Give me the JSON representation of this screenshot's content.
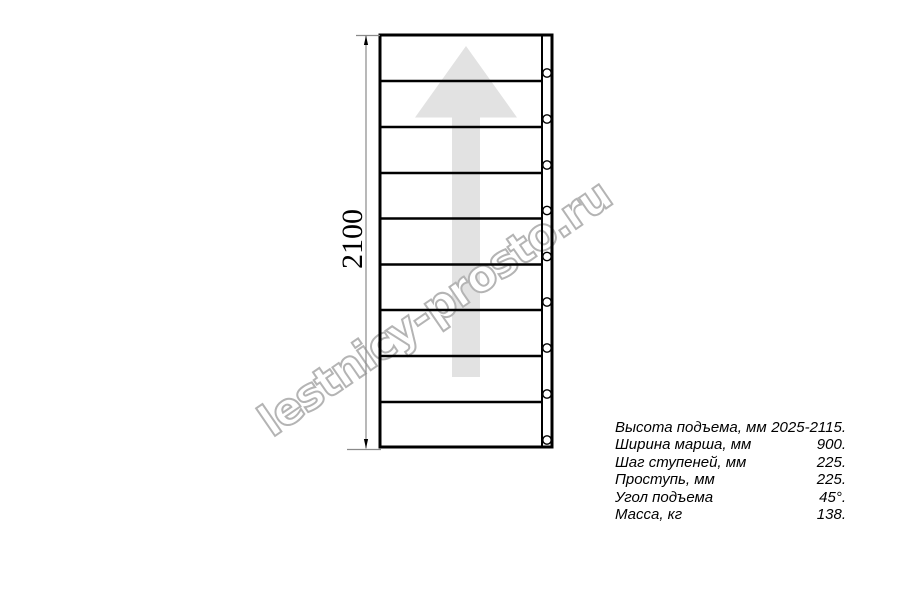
{
  "page": {
    "background": "#ffffff"
  },
  "drawing": {
    "type": "staircase-plan-view",
    "treads_count": 9,
    "holes_count": 9,
    "dimension": {
      "label": "2100"
    },
    "arrow_color": "#e2e2e2",
    "line_color": "#000000",
    "dimension_line_color": "#8a8a8a"
  },
  "watermark": {
    "text": "lestnicy-prosto.ru",
    "color": "#b4b4b4"
  },
  "specs": {
    "rows": [
      {
        "label": "Высота подъема, мм",
        "value": "2025-2115."
      },
      {
        "label": "Ширина марша, мм",
        "value": "900."
      },
      {
        "label": "Шаг ступеней, мм",
        "value": "225."
      },
      {
        "label": "Проступь, мм",
        "value": "225."
      },
      {
        "label": "Угол подъема",
        "value": "45°."
      },
      {
        "label": "Масса, кг",
        "value": "138."
      }
    ]
  }
}
